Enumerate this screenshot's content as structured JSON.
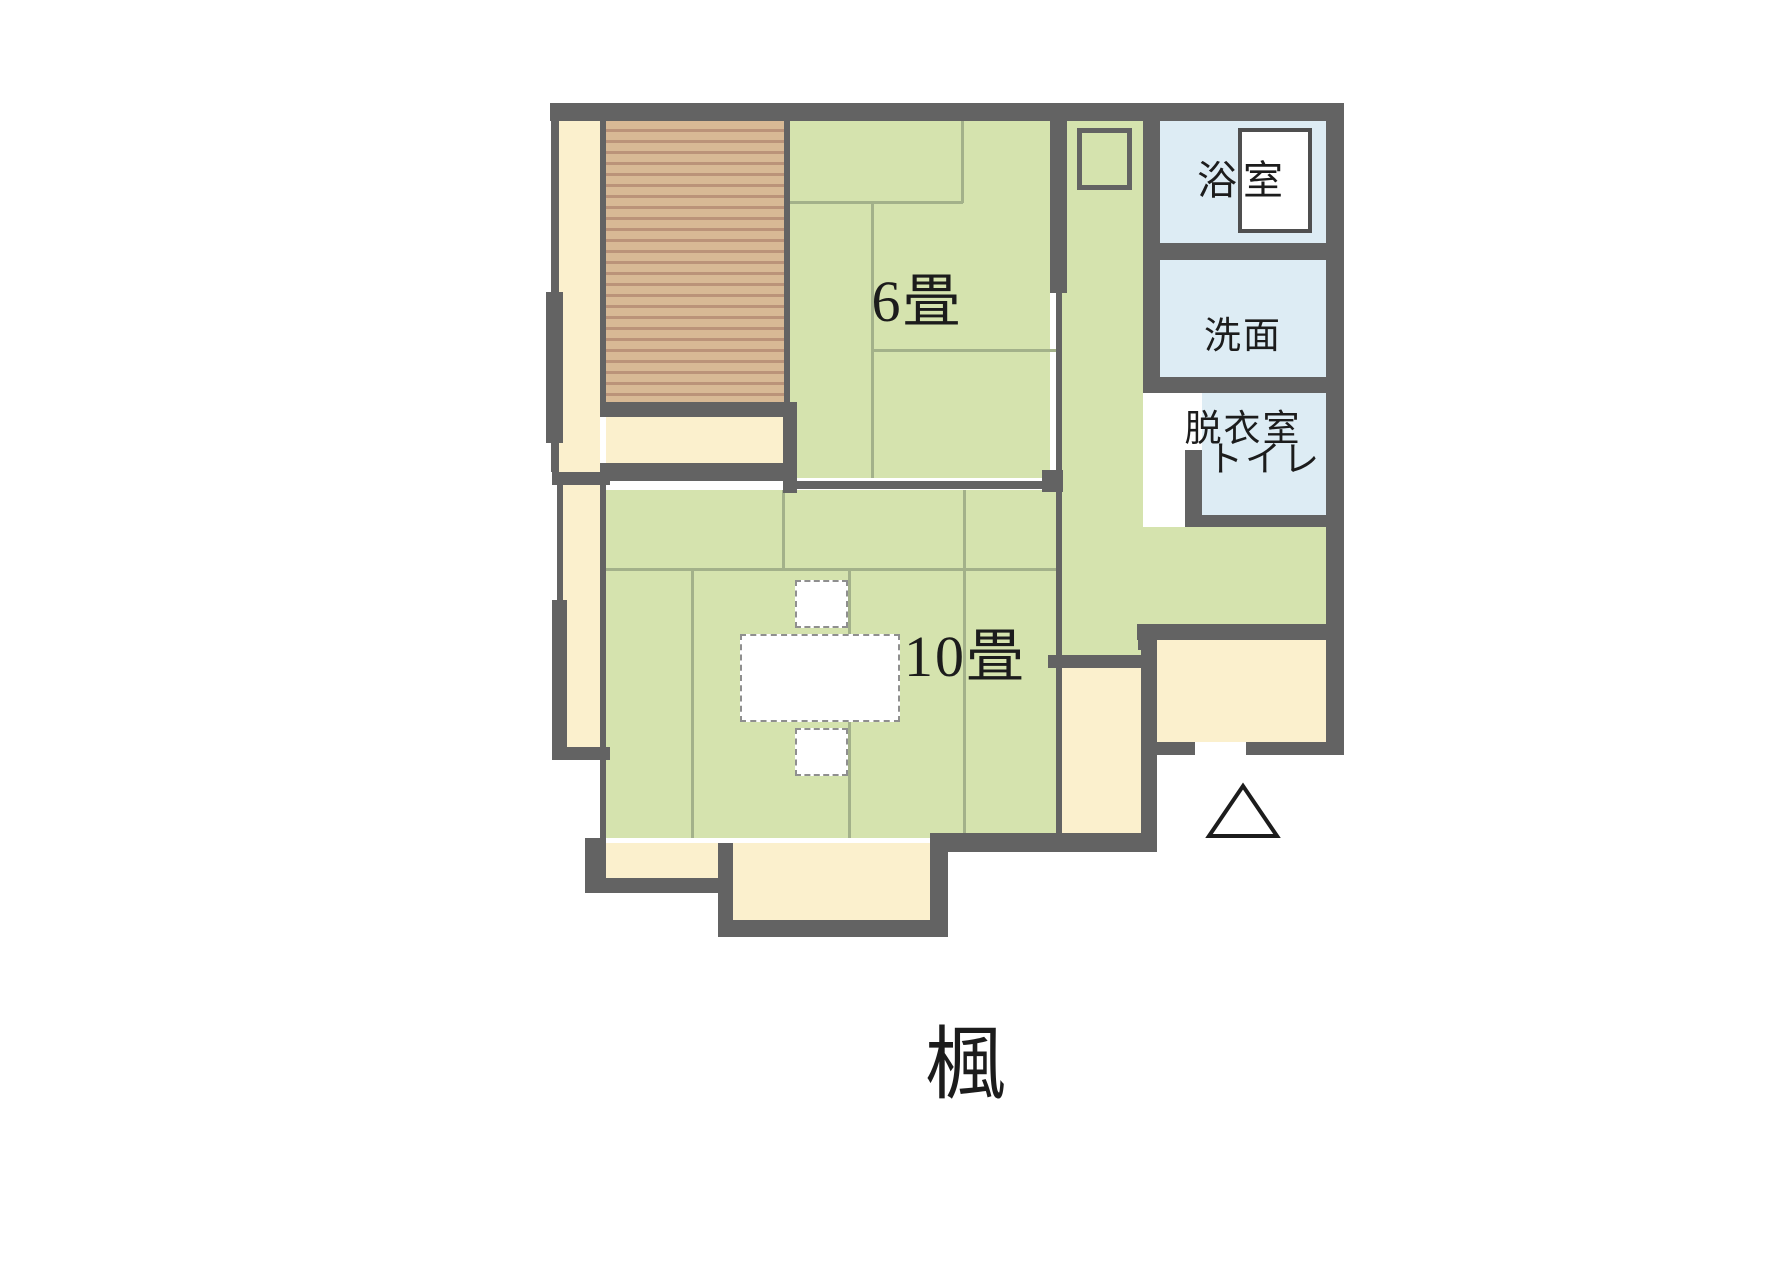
{
  "title": "楓",
  "floor_plan": {
    "rooms": {
      "tatami6": {
        "label": "6畳"
      },
      "tatami10": {
        "label": "10畳"
      },
      "bathroom": {
        "label": "浴室"
      },
      "washroom": {
        "line1": "洗面",
        "line2": "脱衣室"
      },
      "toilet": {
        "label": "トイレ"
      }
    },
    "symbols": {
      "entrance_marker": "triangle-outline",
      "furniture": [
        "bathtub",
        "water-heater-box",
        "low-table",
        "floor-cushion",
        "floor-cushion"
      ]
    },
    "colors": {
      "wall": "#636363",
      "tatami": "#d5e3ae",
      "wet_area": "#ddecf4",
      "closet_cream": "#fbf0cd",
      "wood_deck": "#d8b995",
      "wood_deck_stripe": "#bb9379",
      "tatami_line": "#a3b18a",
      "text": "#1c1c1c",
      "background": "#ffffff"
    }
  }
}
